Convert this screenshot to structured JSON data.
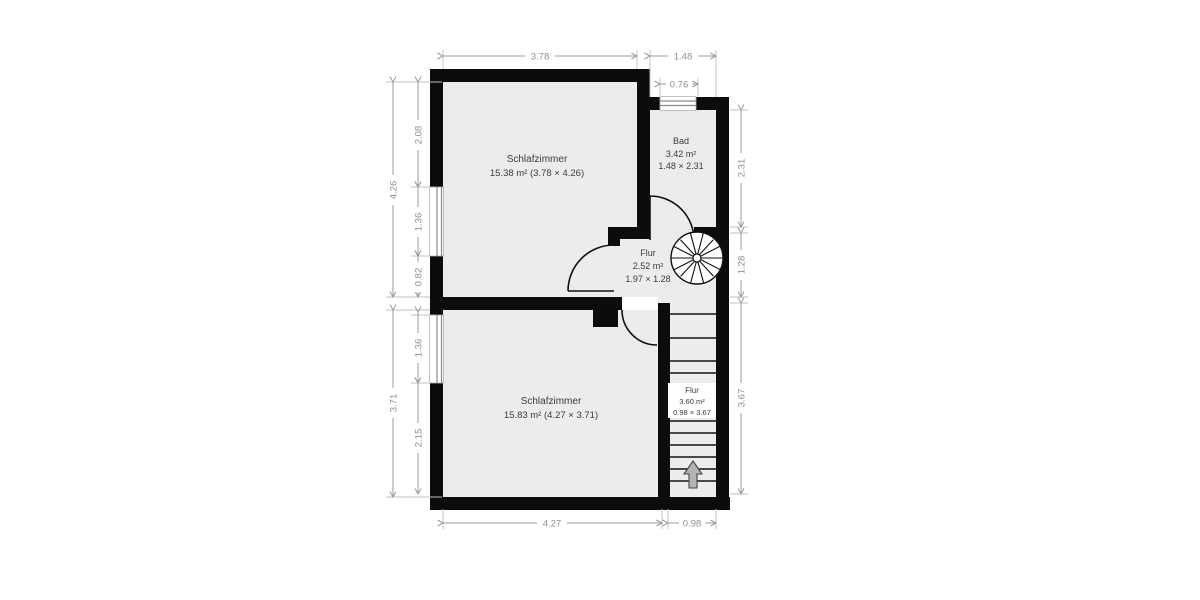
{
  "floorplan": {
    "rooms": {
      "schlafzimmer_top": {
        "name": "Schlafzimmer",
        "details": "15.38 m² (3.78 × 4.26)"
      },
      "bad": {
        "name": "Bad",
        "area": "3.42 m²",
        "dims": "1.48 × 2.31"
      },
      "flur": {
        "name": "Flur",
        "area": "2.52 m²",
        "dims": "1.97 × 1.28"
      },
      "schlafzimmer_bottom": {
        "name": "Schlafzimmer",
        "details": "15.83 m² (4.27 × 3.71)"
      },
      "flur_stairs": {
        "name": "Flur",
        "area": "3.60 m²",
        "dims": "0.98 × 3.67"
      }
    },
    "dimensions": {
      "top_room_width": "3.78",
      "bad_width": "1.48",
      "bad_window_width": "0.76",
      "left_outer_top": "4.26",
      "left_outer_bottom": "3.71",
      "left_top_segment": "2.08",
      "left_window_top": "1.36",
      "left_small_segment": "0.82",
      "left_window_bottom": "1.36",
      "left_bottom_segment": "2.15",
      "right_bad_height": "2.31",
      "right_flur_height": "1.28",
      "right_stairs_height": "3.67",
      "bottom_room_width": "4.27",
      "bottom_stairs_width": "0.98"
    },
    "colors": {
      "wall": "#0c0c0c",
      "floor": "#ececec",
      "dimension": "#9b9b9b",
      "label_text": "#3c3c3c",
      "background": "#ffffff"
    },
    "icons": [
      "spiral-staircase-icon",
      "stairs-up-arrow-icon",
      "chimney-block"
    ]
  }
}
